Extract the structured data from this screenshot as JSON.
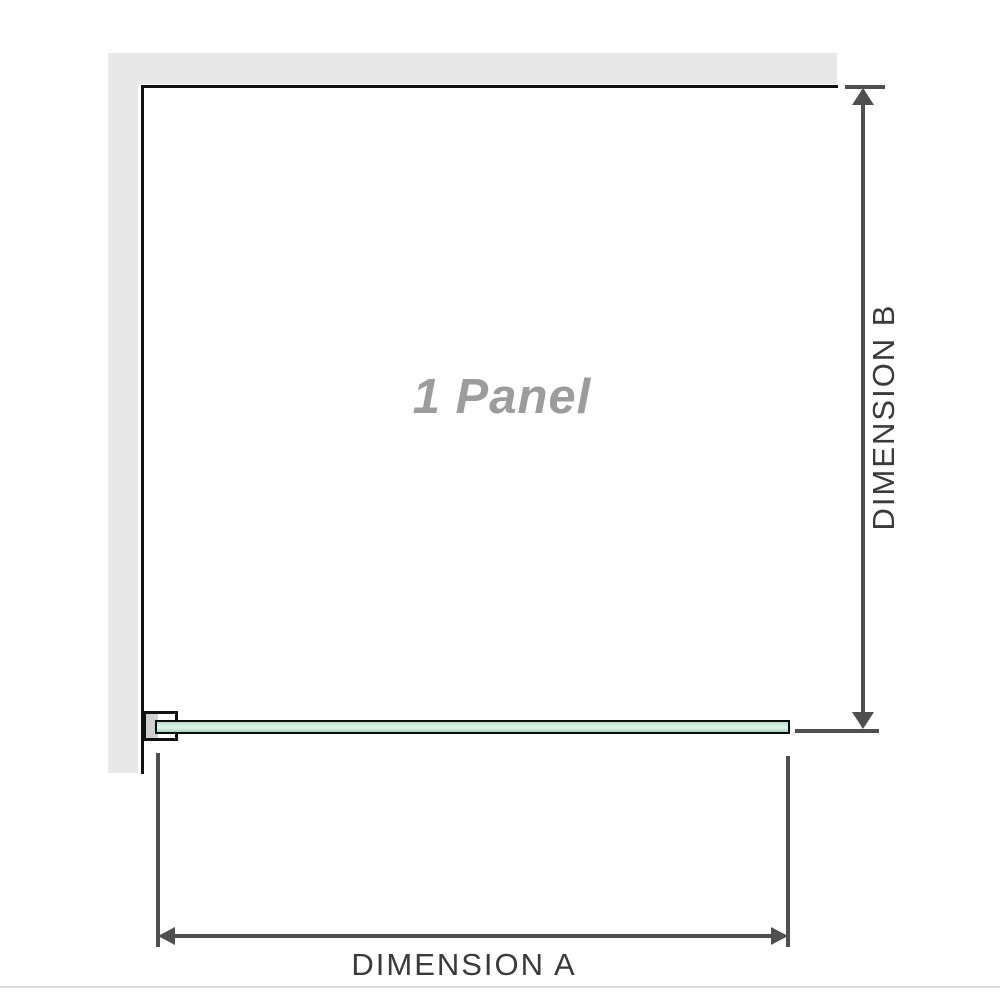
{
  "diagram": {
    "panel_label": "1 Panel",
    "dimension_a_label": "DIMENSION A",
    "dimension_b_label": "DIMENSION B"
  },
  "colors": {
    "wall": "#e8e8e8",
    "outline": "#111111",
    "dim_line": "#4f4f4f",
    "dim_text": "#3a3a3a",
    "panel_text": "#9c9c9c",
    "glass_top": "#b7dfc8",
    "glass_mid": "#e2f3ea",
    "glass_bottom": "#a3d6b8",
    "bracket_fill": "#cfcfcf",
    "divider": "#dcdcdc"
  }
}
